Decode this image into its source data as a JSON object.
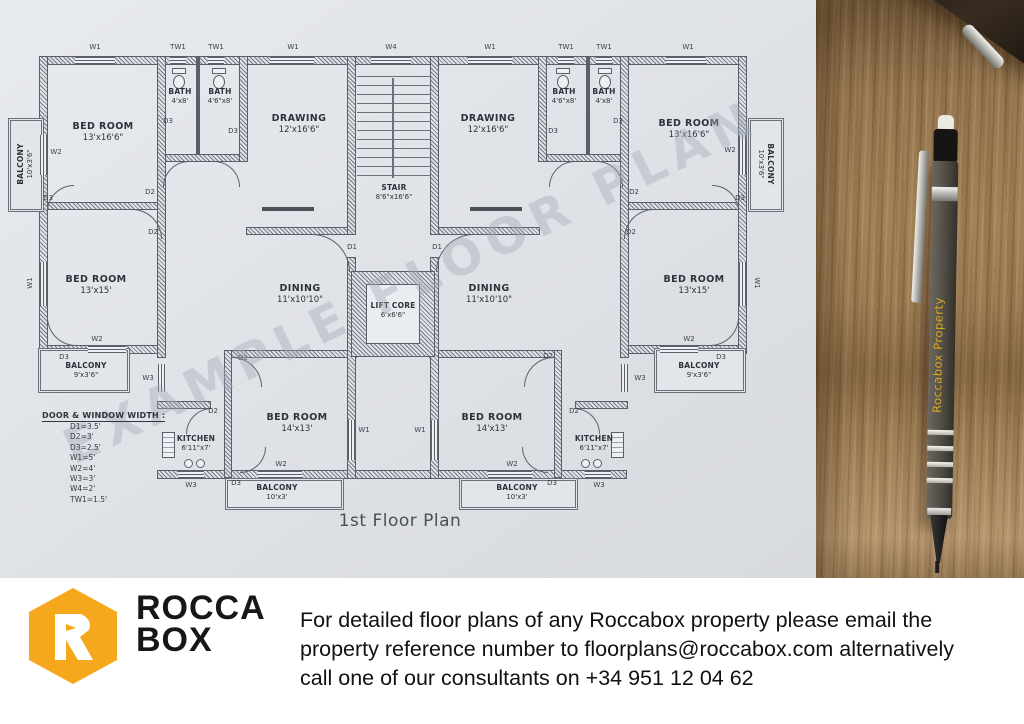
{
  "photo": {
    "watermark": "EXAMPLE FLOOR PLAN",
    "pen_text": "Roccabox Property"
  },
  "plan": {
    "title": "1st Floor Plan",
    "legend_title": "DOOR & WINDOW WIDTH :",
    "legend": [
      "D1=3.5'",
      "D2=3'",
      "D3=2.5'",
      "W1=5'",
      "W2=4'",
      "W3=3'",
      "W4=2'",
      "TW1=1.5'"
    ],
    "rooms": [
      {
        "name": "BED ROOM",
        "dims": "13'x16'6\"",
        "x": 103,
        "y": 132
      },
      {
        "name": "BATH",
        "dims": "4'x8'",
        "x": 180,
        "y": 96,
        "small": true
      },
      {
        "name": "BATH",
        "dims": "4'6\"x8'",
        "x": 220,
        "y": 96,
        "small": true
      },
      {
        "name": "DRAWING",
        "dims": "12'x16'6\"",
        "x": 299,
        "y": 124
      },
      {
        "name": "STAIR",
        "dims": "8'6\"x16'6\"",
        "x": 394,
        "y": 192,
        "small": true
      },
      {
        "name": "DRAWING",
        "dims": "12'x16'6\"",
        "x": 488,
        "y": 124
      },
      {
        "name": "BATH",
        "dims": "4'6\"x8'",
        "x": 564,
        "y": 96,
        "small": true
      },
      {
        "name": "BATH",
        "dims": "4'x8'",
        "x": 604,
        "y": 96,
        "small": true
      },
      {
        "name": "BED ROOM",
        "dims": "13'x16'6\"",
        "x": 689,
        "y": 129
      },
      {
        "name": "BED ROOM",
        "dims": "13'x15'",
        "x": 96,
        "y": 285
      },
      {
        "name": "DINING",
        "dims": "11'x10'10\"",
        "x": 300,
        "y": 294
      },
      {
        "name": "LIFT CORE",
        "dims": "6'x6'6\"",
        "x": 393,
        "y": 310,
        "small": true
      },
      {
        "name": "DINING",
        "dims": "11'x10'10\"",
        "x": 489,
        "y": 294
      },
      {
        "name": "BED ROOM",
        "dims": "13'x15'",
        "x": 694,
        "y": 285
      },
      {
        "name": "BALCONY",
        "dims": "9'x3'6\"",
        "x": 86,
        "y": 370,
        "small": true
      },
      {
        "name": "BALCONY",
        "dims": "9'x3'6\"",
        "x": 699,
        "y": 370,
        "small": true
      },
      {
        "name": "BED ROOM",
        "dims": "14'x13'",
        "x": 297,
        "y": 423
      },
      {
        "name": "BED ROOM",
        "dims": "14'x13'",
        "x": 492,
        "y": 423
      },
      {
        "name": "KITCHEN",
        "dims": "6'11\"x7'",
        "x": 196,
        "y": 443,
        "small": true
      },
      {
        "name": "KITCHEN",
        "dims": "6'11\"x7'",
        "x": 594,
        "y": 443,
        "small": true
      },
      {
        "name": "BALCONY",
        "dims": "10'x3'",
        "x": 277,
        "y": 492,
        "small": true
      },
      {
        "name": "BALCONY",
        "dims": "10'x3'",
        "x": 517,
        "y": 492,
        "small": true
      },
      {
        "name": "BALCONY",
        "dims": "10'x3'6\"",
        "x": 25,
        "y": 164,
        "rot": -90,
        "small": true
      },
      {
        "name": "BALCONY",
        "dims": "10'x3'6\"",
        "x": 766,
        "y": 164,
        "rot": 90,
        "small": true
      }
    ],
    "tags": [
      {
        "t": "W1",
        "x": 95,
        "y": 47
      },
      {
        "t": "TW1",
        "x": 178,
        "y": 47
      },
      {
        "t": "TW1",
        "x": 216,
        "y": 47
      },
      {
        "t": "W1",
        "x": 293,
        "y": 47
      },
      {
        "t": "W4",
        "x": 391,
        "y": 47
      },
      {
        "t": "W1",
        "x": 490,
        "y": 47
      },
      {
        "t": "TW1",
        "x": 566,
        "y": 47
      },
      {
        "t": "TW1",
        "x": 604,
        "y": 47
      },
      {
        "t": "W1",
        "x": 688,
        "y": 47
      },
      {
        "t": "W2",
        "x": 56,
        "y": 152
      },
      {
        "t": "D3",
        "x": 48,
        "y": 198
      },
      {
        "t": "W1",
        "x": 30,
        "y": 283,
        "rot": -90
      },
      {
        "t": "W2",
        "x": 730,
        "y": 150
      },
      {
        "t": "D3",
        "x": 740,
        "y": 198
      },
      {
        "t": "W1",
        "x": 757,
        "y": 283,
        "rot": 90
      },
      {
        "t": "D2",
        "x": 150,
        "y": 192
      },
      {
        "t": "D2",
        "x": 153,
        "y": 232
      },
      {
        "t": "D2",
        "x": 634,
        "y": 192
      },
      {
        "t": "D2",
        "x": 631,
        "y": 232
      },
      {
        "t": "D3",
        "x": 168,
        "y": 121
      },
      {
        "t": "D3",
        "x": 233,
        "y": 131
      },
      {
        "t": "D3",
        "x": 618,
        "y": 121
      },
      {
        "t": "D3",
        "x": 553,
        "y": 131
      },
      {
        "t": "W2",
        "x": 97,
        "y": 339
      },
      {
        "t": "D3",
        "x": 64,
        "y": 357
      },
      {
        "t": "W2",
        "x": 689,
        "y": 339
      },
      {
        "t": "D3",
        "x": 721,
        "y": 357
      },
      {
        "t": "W3",
        "x": 148,
        "y": 378
      },
      {
        "t": "W3",
        "x": 640,
        "y": 378
      },
      {
        "t": "D2",
        "x": 243,
        "y": 358
      },
      {
        "t": "D2",
        "x": 548,
        "y": 356
      },
      {
        "t": "D2",
        "x": 213,
        "y": 411
      },
      {
        "t": "D2",
        "x": 574,
        "y": 411
      },
      {
        "t": "W1",
        "x": 364,
        "y": 430
      },
      {
        "t": "W1",
        "x": 420,
        "y": 430
      },
      {
        "t": "W2",
        "x": 281,
        "y": 464
      },
      {
        "t": "W2",
        "x": 512,
        "y": 464
      },
      {
        "t": "W3",
        "x": 191,
        "y": 485
      },
      {
        "t": "W3",
        "x": 599,
        "y": 485
      },
      {
        "t": "D3",
        "x": 236,
        "y": 483
      },
      {
        "t": "D3",
        "x": 552,
        "y": 483
      },
      {
        "t": "D1",
        "x": 352,
        "y": 247
      },
      {
        "t": "D1",
        "x": 437,
        "y": 247
      }
    ]
  },
  "logo": {
    "word1": "ROCCA",
    "word2": "BOX",
    "color": "#F5A81C"
  },
  "footer": {
    "lines": [
      "For detailed floor plans of any Roccabox property please email the",
      "property reference number to floorplans@roccabox.com alternatively",
      "call one of our consultants on +34 951 12 04 62"
    ]
  }
}
